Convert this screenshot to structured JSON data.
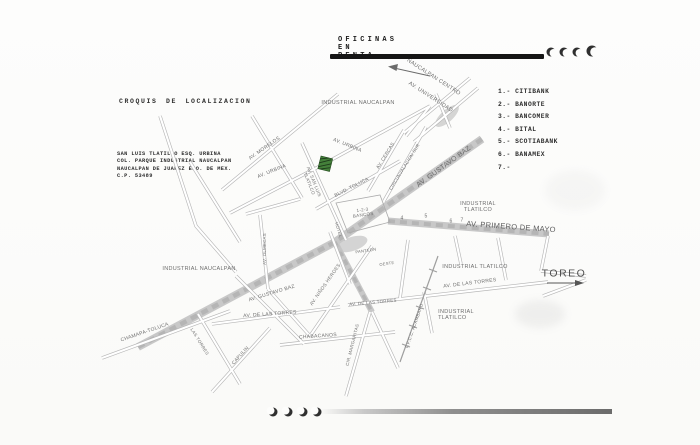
{
  "header": {
    "title": "OFICINAS EN RENTA"
  },
  "legend": {
    "items": [
      "1.- CITIBANK",
      "2.- BANORTE",
      "3.- BANCOMER",
      "4.- BITAL",
      "5.- SCOTIABANK",
      "6.- BANAMEX",
      "7.-"
    ]
  },
  "info": {
    "title": "CROQUIS DE LOCALIZACION",
    "address_lines": [
      "SAN LUIS TLATILCO ESQ. URBINA",
      "COL. PARQUE INDUSTRIAL NAUCALPAN",
      "NAUCALPAN DE JUAREZ EDO. DE MEX.",
      "C.P. 53489"
    ]
  },
  "map": {
    "labels": {
      "naucalpan_centro": "NAUCALPAN CENTRO",
      "av_universidad": "AV. UNIVERSIDAD",
      "industrial_naucalpan_top": "INDUSTRIAL NAUCALPAN",
      "av_morelos": "AV. MORELOS",
      "av_urbina_left": "AV. URBINA",
      "av_urbina_top": "AV. URBINA",
      "av_san_luis_l1": "AV. SAN LUIS",
      "av_san_luis_l2": "TLATILCO",
      "blvd_toluca": "BLVD. TOLUCA",
      "av_cercas": "AV. CERCAS",
      "circunvalacion_sur": "CIRCUNVALACION SUR",
      "av_gustavo_baz_upper": "AV. GUSTAVO BAZ",
      "banks_l1": "1-2-3",
      "banks_l2": "BANCOS",
      "hotel": "HOTEL",
      "industrial_tlatilco_1a": "INDUSTRIAL",
      "industrial_tlatilco_1b": "TLATILCO",
      "num4": "4",
      "num5": "5",
      "num6": "6",
      "num7": "7",
      "av_primero_de_mayo": "AV. PRIMERO DE MAYO",
      "industrial_naucalpan_left": "INDUSTRIAL NAUCALPAN",
      "av_olmecas": "AV. OLMECAS",
      "av_gustavo_baz_lower": "AV. GUSTAVO BAZ",
      "av_ninos_heroes": "AV. NIÑOS HEROES",
      "panteon": "PANTEON",
      "oeste": "OESTE",
      "industrial_tlatilco_2": "INDUSTRIAL TLATILCO",
      "av_torres_right": "AV. DE LAS TORRES",
      "av_torres_mid": "AV. DE LAS TORRES",
      "av_torres_left": "AV. DE LAS TORRES",
      "toreo": "TOREO",
      "ffcc_acambaro": "F.F.C.C. ACAMBARO",
      "industrial_tlatilco_3a": "INDUSTRIAL",
      "industrial_tlatilco_3b": "TLATILCO",
      "chabacanos": "CHABACANOS",
      "capulin": "CAPULIN",
      "cir_margaritas": "CIR. MARGARITAS",
      "las_torres": "LAS TORRES",
      "chamapa_toluca": "CHAMAPA-TOLUCA"
    },
    "colors": {
      "marker_green": "#44803a",
      "road_gray": "#c4c4c4",
      "bar_black": "#151515"
    }
  }
}
